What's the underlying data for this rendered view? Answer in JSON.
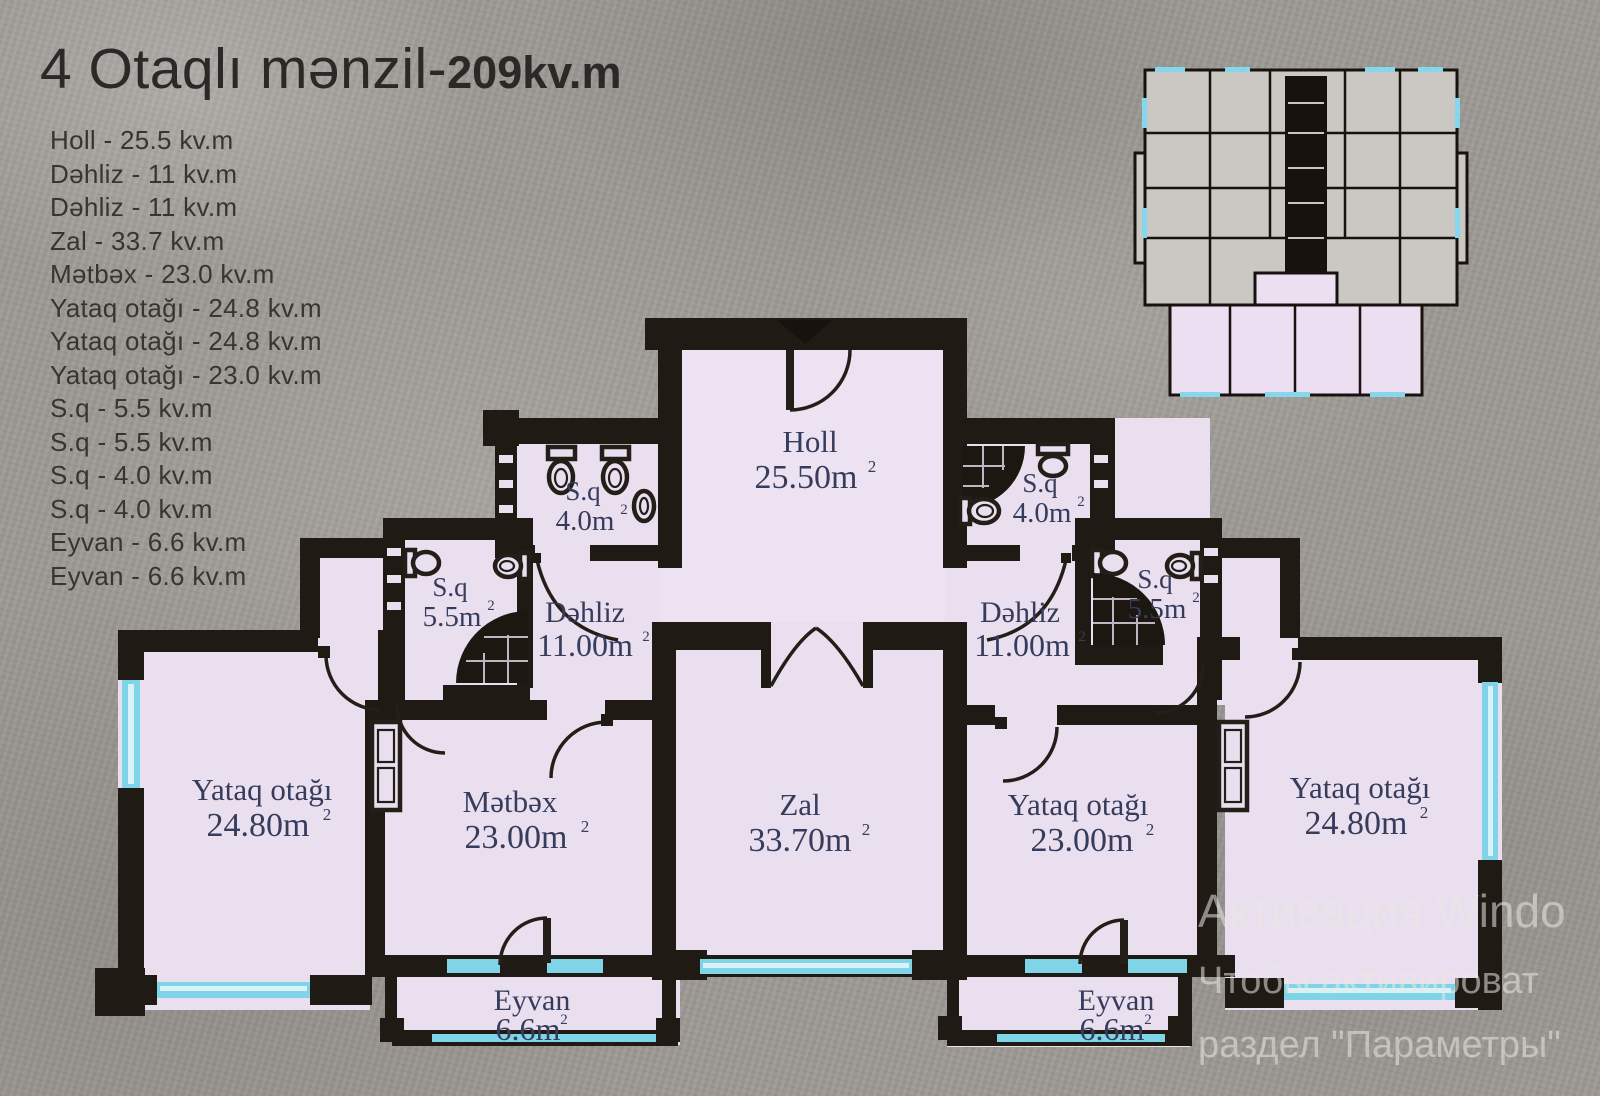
{
  "title": {
    "main": "4 Otaqlı mənzil-",
    "area": "209kv.m"
  },
  "room_list": [
    "Holl - 25.5 kv.m",
    "Dəhliz - 11 kv.m",
    "Dəhliz - 11 kv.m",
    "Zal - 33.7 kv.m",
    "Mətbəx - 23.0 kv.m",
    "Yataq otağı - 24.8 kv.m",
    "Yataq otağı - 24.8 kv.m",
    "Yataq otağı - 23.0 kv.m",
    "S.q - 5.5 kv.m",
    "S.q - 5.5 kv.m",
    "S.q - 4.0 kv.m",
    "S.q - 4.0 kv.m",
    "Eyvan - 6.6 kv.m",
    "Eyvan - 6.6 kv.m"
  ],
  "sup": "2",
  "rooms": {
    "holl": {
      "name": "Holl",
      "area": "25.50m"
    },
    "zal": {
      "name": "Zal",
      "area": "33.70m"
    },
    "metbex": {
      "name": "Mətbəx",
      "area": "23.00m"
    },
    "dehliz_l": {
      "name": "Dəhliz",
      "area": "11.00m"
    },
    "dehliz_r": {
      "name": "Dəhliz",
      "area": "11.00m"
    },
    "yataq_left": {
      "name": "Yataq otağı",
      "area": "24.80m"
    },
    "yataq_mid": {
      "name": "Yataq otağı",
      "area": "23.00m"
    },
    "yataq_right": {
      "name": "Yataq otağı",
      "area": "24.80m"
    },
    "sq40_l": {
      "name": "S.q",
      "area": "4.0m"
    },
    "sq40_r": {
      "name": "S.q",
      "area": "4.0m"
    },
    "sq55_l": {
      "name": "S.q",
      "area": "5.5m"
    },
    "sq55_r": {
      "name": "S.q",
      "area": "5.5m"
    },
    "eyvan_l": {
      "name": "Eyvan",
      "area": "6.6m"
    },
    "eyvan_r": {
      "name": "Eyvan",
      "area": "6.6m"
    }
  },
  "watermark": {
    "line1": "Активация Windo",
    "line2": "Чтобы активироват",
    "line3": "раздел \"Параметры\""
  },
  "colors": {
    "wall": "#201a15",
    "room": "#eadfef",
    "window": "#7fd4e8",
    "label": "#363c5c"
  }
}
